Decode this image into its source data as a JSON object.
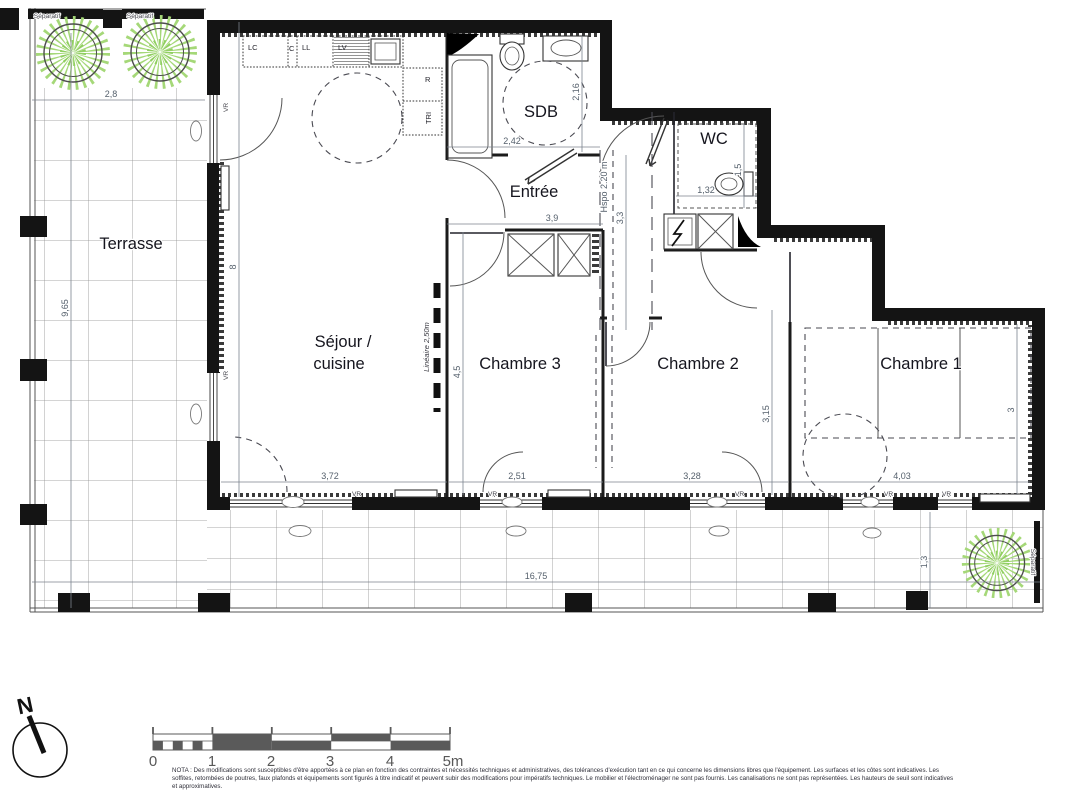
{
  "rooms": {
    "terrasse": "Terrasse",
    "sejour1": "Séjour /",
    "sejour2": "cuisine",
    "entree": "Entrée",
    "sdb": "SDB",
    "wc": "WC",
    "chambre1": "Chambre 1",
    "chambre2": "Chambre 2",
    "chambre3": "Chambre 3"
  },
  "dims": {
    "w2_8": "2,8",
    "h9_65": "9,65",
    "h8": "8",
    "w2_42": "2,42",
    "h2_16": "2,16",
    "w3_9": "3,9",
    "h3_3": "3,3",
    "h1_5": "1,5",
    "w1_32": "1,32",
    "h4_5": "4,5",
    "w2_51": "2,51",
    "h3_15": "3,15",
    "w3_28": "3,28",
    "w4_03": "4,03",
    "h3": "3",
    "w3_72": "3,72",
    "w16_75": "16,75",
    "h1_3": "1,3"
  },
  "kitchen": {
    "lc": "LC",
    "c": "C",
    "ll": "LL",
    "lv": "LV",
    "r": "R",
    "tri": "TRI"
  },
  "ann": {
    "separatif": "Séparatif",
    "vr": "VR",
    "lineaire": "Linéaire 2,50m",
    "hspo": "Hspo 2.20 m"
  },
  "compass": {
    "n": "N"
  },
  "scalebar": {
    "t0": "0",
    "t1": "1",
    "t2": "2",
    "t3": "3",
    "t4": "4",
    "t5": "5m"
  },
  "nota": {
    "line1": "NOTA : Des modifications sont susceptibles d'être apportées à ce plan en fonction des contraintes et nécessités techniques et administratives, des tolérances d'exécution tant en ce qui concerne les dimensions libres que l'équipement. Les surfaces et les côtes sont indicatives. Les",
    "line2": "soffites, retombées de poutres, faux plafonds et équipements sont figurés à titre indicatif et peuvent subir des modifications pour impératifs techniques. Le mobilier et l'électroménager ne sont pas fournis. Les canalisations ne sont pas représentées. Les hauteurs de seuil sont indicatives",
    "line3": "et approximatives."
  },
  "colors": {
    "tree_green": "#a5d878",
    "wall": "#141414",
    "dim_text": "#55606c",
    "scalebar": "#5a5a5a"
  }
}
